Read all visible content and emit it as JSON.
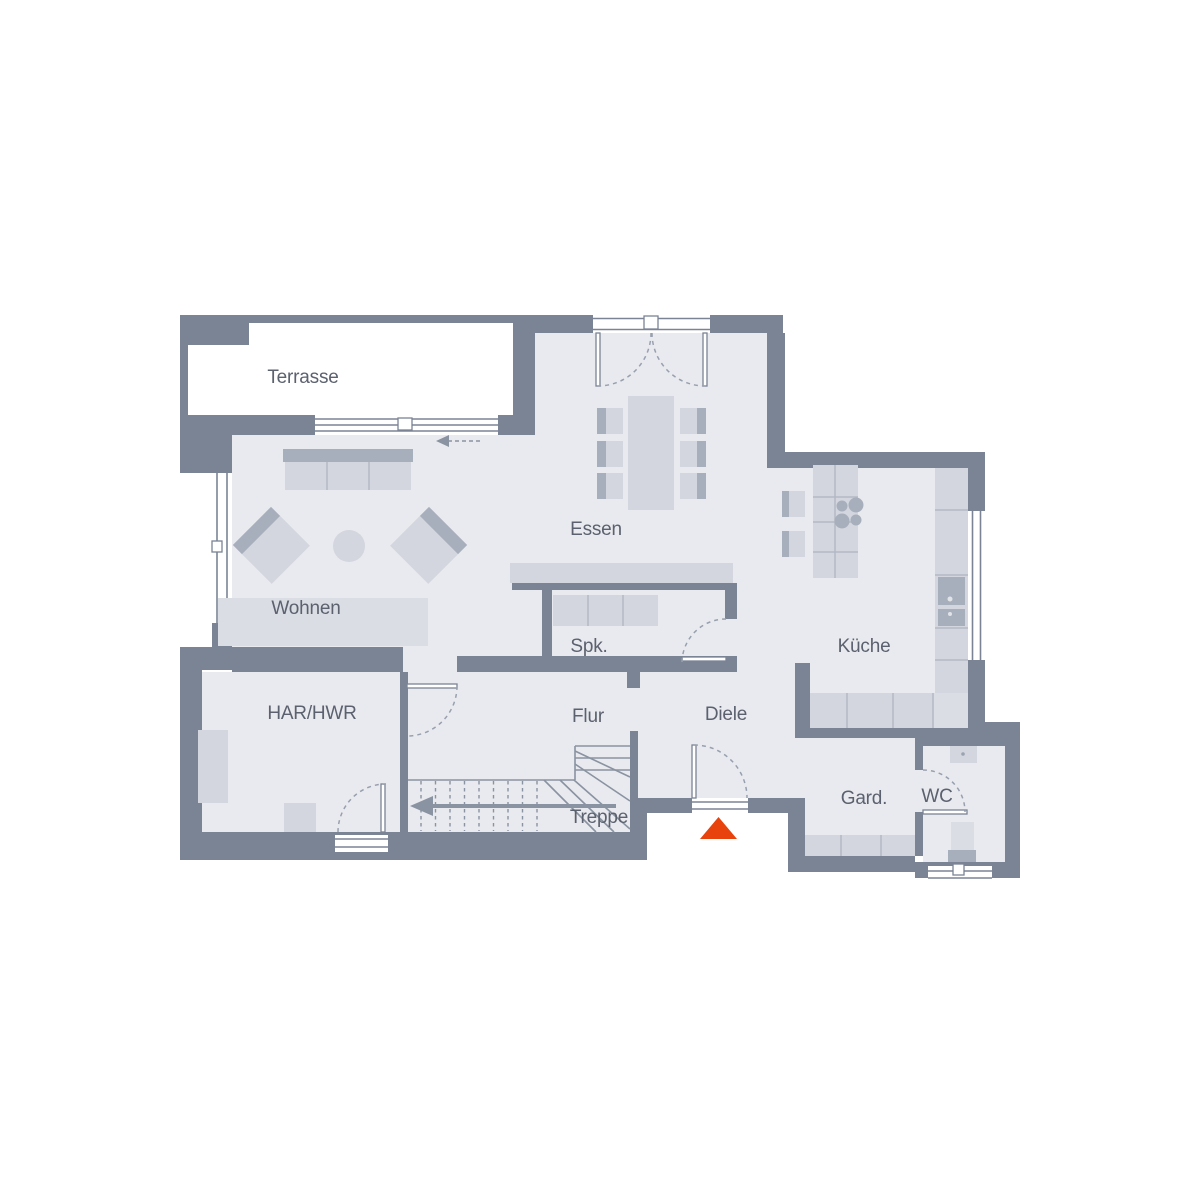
{
  "plan": {
    "title": "floor-plan-ground-floor",
    "background": "#ffffff",
    "colors": {
      "wall": "#7b8495",
      "floor": "#e9eaef",
      "furniture": "#d3d6de",
      "furniture_dark": "#a8afbc",
      "line": "#8a93a1",
      "label": "#5b616e",
      "entrance_marker": "#e8420d"
    },
    "rooms": [
      {
        "id": "terrasse",
        "label": "Terrasse"
      },
      {
        "id": "wohnen",
        "label": "Wohnen"
      },
      {
        "id": "essen",
        "label": "Essen"
      },
      {
        "id": "spk",
        "label": "Spk."
      },
      {
        "id": "kueche",
        "label": "Küche"
      },
      {
        "id": "har-hwr",
        "label": "HAR/HWR"
      },
      {
        "id": "flur",
        "label": "Flur"
      },
      {
        "id": "diele",
        "label": "Diele"
      },
      {
        "id": "treppe",
        "label": "Treppe"
      },
      {
        "id": "gard",
        "label": "Gard."
      },
      {
        "id": "wc",
        "label": "WC"
      }
    ]
  }
}
